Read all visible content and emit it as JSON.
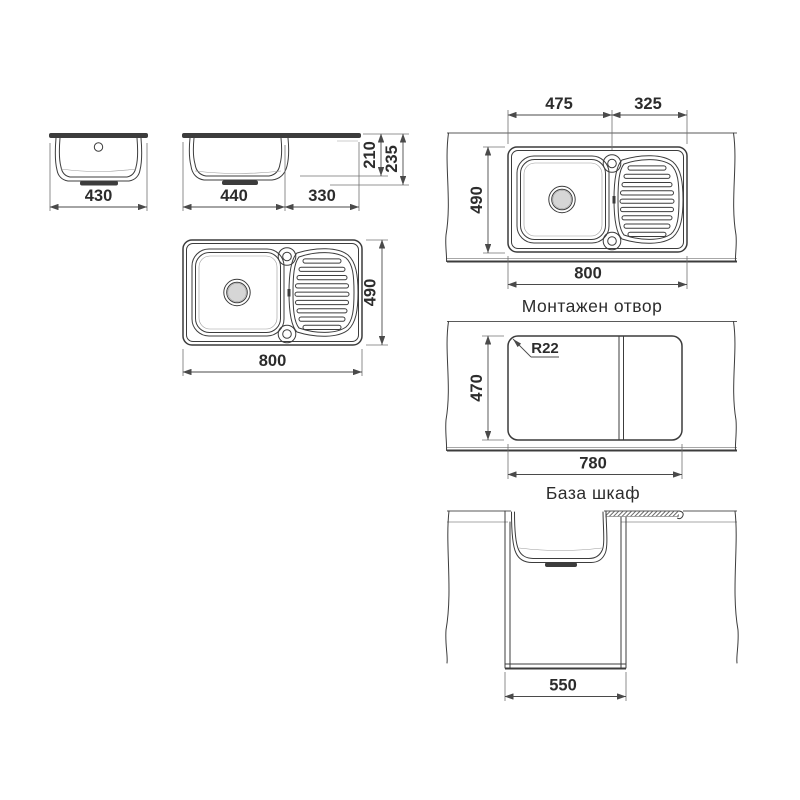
{
  "front_view": {
    "dim_width": "430"
  },
  "side_view": {
    "dim_bowl": "440",
    "dim_board": "330",
    "dim_depth": "210",
    "dim_height": "235"
  },
  "plan_view": {
    "dim_length": "800",
    "dim_width": "490"
  },
  "mount_view": {
    "caption": "Монтажен отвор",
    "dim_bowl_center": "475",
    "dim_rest": "325",
    "dim_width": "490",
    "dim_length": "800"
  },
  "cutout_view": {
    "caption": "База шкаф",
    "dim_radius": "R22",
    "dim_width": "470",
    "dim_length": "780"
  },
  "cabinet_view": {
    "dim_width": "550"
  }
}
